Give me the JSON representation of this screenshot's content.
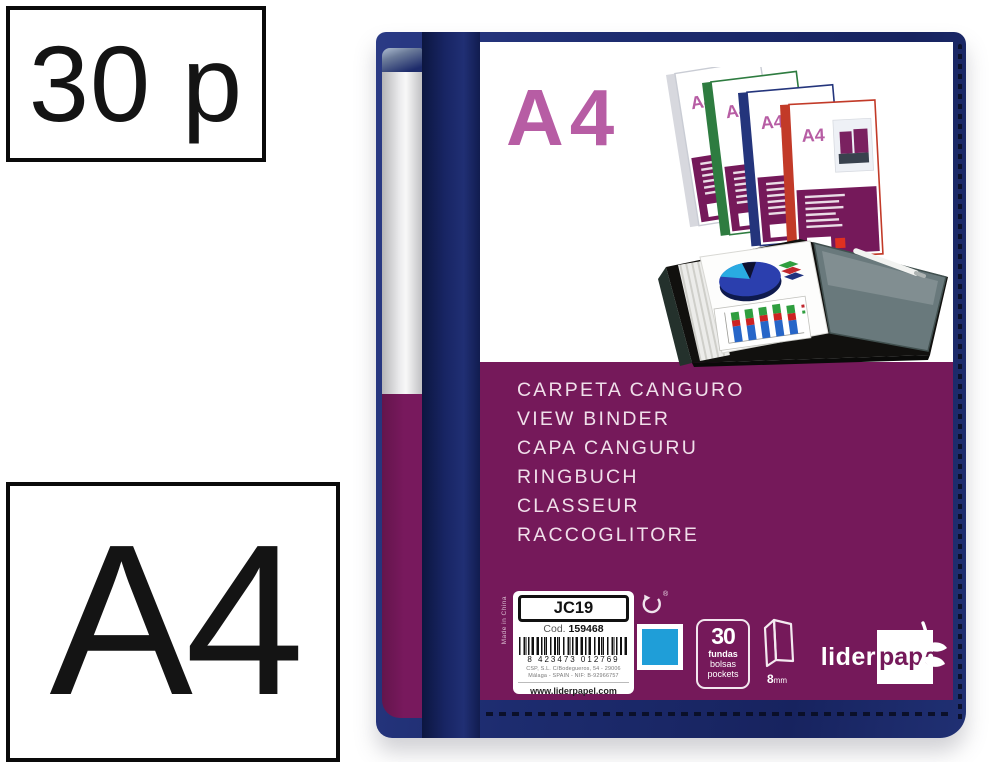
{
  "page": {
    "pages_badge": "30 p",
    "format_badge": "A4"
  },
  "cover": {
    "format_title": "A4",
    "product_names": [
      "CARPETA CANGURO",
      "VIEW BINDER",
      "CAPA CANGURU",
      "RINGBUCH",
      "CLASSEUR",
      "RACCOGLITORE"
    ]
  },
  "montage": {
    "mini_format_label": "A4"
  },
  "label": {
    "model": "JC19",
    "code_prefix": "Cod.",
    "code_value": "159468",
    "barcode_digits": "8 423473 012769",
    "address_line_1": "CSP, S.L. C/Bodegueros, 54 - 29006",
    "address_line_2": "Málaga - SPAIN - NIF: B-92966757",
    "website": "www.liderpapel.com",
    "made_in": "Made in China",
    "registered_mark": "®"
  },
  "specs": {
    "pockets_count": "30",
    "pockets_word_1": "fundas",
    "pockets_word_2": "bolsas",
    "pockets_word_3": "pockets",
    "spine_width_value": "8",
    "spine_width_unit": "mm"
  },
  "brand": {
    "name_part_1": "lider",
    "name_part_2": "pape",
    "name_part_3": "l"
  },
  "colors": {
    "navy": "#1b2a6b",
    "purple": "#75195a",
    "pink_accent": "#b75da4",
    "swatch_blue": "#1f9ed8"
  }
}
